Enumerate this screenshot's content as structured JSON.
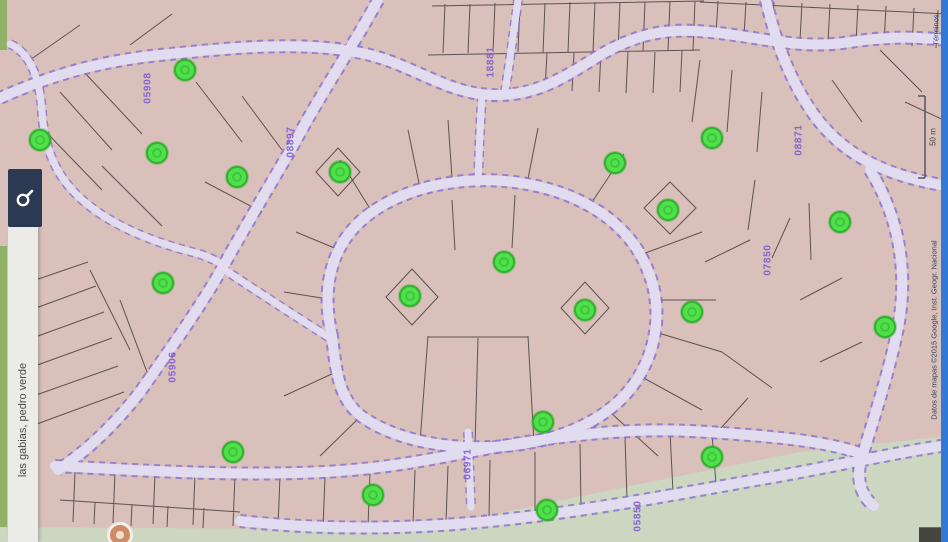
{
  "app": {
    "type": "map-viewer"
  },
  "colors": {
    "parcel-fill": "#d9c0bb",
    "road-fill": "#e2dcf0",
    "road-edge": "#8b74cf",
    "parcel-line": "#463e3e",
    "green-area": "#ccd6c1",
    "green-stripe": "#8fb168",
    "marker-fill": "#50e04c",
    "marker-ring": "#2fb32c",
    "label-purple": "#7d5cd4",
    "label-blue": "#2c3fd0",
    "button-bg": "#2b3a52",
    "bar-bg": "#ebebe7",
    "edge-strip": "#3179d8",
    "attribution-color": "#33475a"
  },
  "search": {
    "query": "las gabias, pedro verde",
    "button_icon": "search-icon"
  },
  "map": {
    "labels": [
      {
        "text": "05908",
        "x": 148,
        "y": 88,
        "kind": "parcel"
      },
      {
        "text": "08897",
        "x": 291,
        "y": 142,
        "kind": "parcel"
      },
      {
        "text": "18881",
        "x": 491,
        "y": 62,
        "kind": "parcel"
      },
      {
        "text": "08871",
        "x": 799,
        "y": 140,
        "kind": "parcel"
      },
      {
        "text": "07850",
        "x": 768,
        "y": 260,
        "kind": "parcel"
      },
      {
        "text": "05906",
        "x": 173,
        "y": 367,
        "kind": "parcel"
      },
      {
        "text": "06971",
        "x": 468,
        "y": 464,
        "kind": "parcel"
      },
      {
        "text": "05850",
        "x": 638,
        "y": 516,
        "kind": "parcel"
      },
      {
        "text": "12",
        "x": 30,
        "y": 177,
        "kind": "house"
      }
    ],
    "markers": [
      {
        "x": 40,
        "y": 140
      },
      {
        "x": 185,
        "y": 70
      },
      {
        "x": 157,
        "y": 153
      },
      {
        "x": 237,
        "y": 177
      },
      {
        "x": 340,
        "y": 172
      },
      {
        "x": 163,
        "y": 283
      },
      {
        "x": 410,
        "y": 296
      },
      {
        "x": 504,
        "y": 262
      },
      {
        "x": 615,
        "y": 163
      },
      {
        "x": 712,
        "y": 138
      },
      {
        "x": 668,
        "y": 210
      },
      {
        "x": 840,
        "y": 222
      },
      {
        "x": 585,
        "y": 310
      },
      {
        "x": 692,
        "y": 312
      },
      {
        "x": 885,
        "y": 327
      },
      {
        "x": 233,
        "y": 452
      },
      {
        "x": 373,
        "y": 495
      },
      {
        "x": 543,
        "y": 422
      },
      {
        "x": 547,
        "y": 510
      },
      {
        "x": 712,
        "y": 457
      }
    ]
  },
  "attribution": {
    "text": "Datos de mapas ©2015 Google, Inst. Geogr. Nacional",
    "scale_label": "50 m",
    "terms_label": "Términos"
  }
}
